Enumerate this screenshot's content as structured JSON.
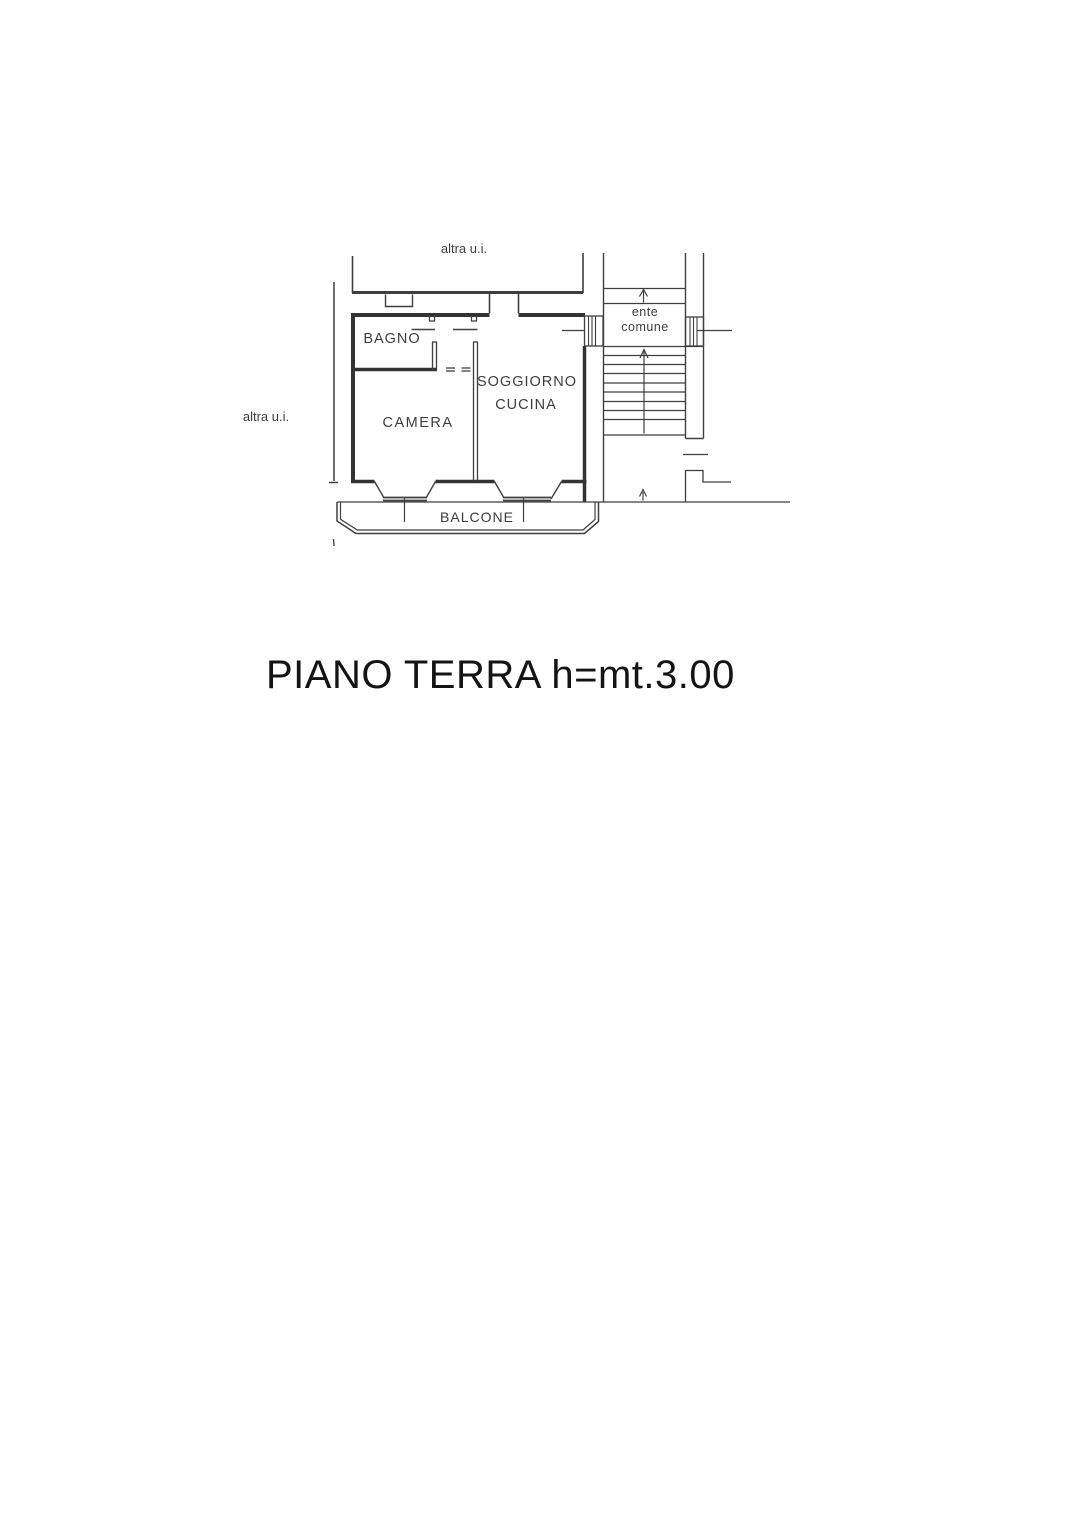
{
  "title": {
    "text": "PIANO TERRA h=mt.3.00"
  },
  "floor_plan": {
    "labels": {
      "altra_ui_top": "altra u.i.",
      "altra_ui_left": "altra u.i.",
      "bagno": "BAGNO",
      "camera": "CAMERA",
      "soggiorno": "SOGGIORNO",
      "cucina": "CUCINA",
      "ente_line1": "ente",
      "ente_line2": "comune",
      "balcone": "BALCONE"
    },
    "colors": {
      "bg": "#ffffff",
      "line": "#3f3f3f",
      "wall": "#333333",
      "text": "#3d3d3d",
      "title": "#141414"
    }
  }
}
